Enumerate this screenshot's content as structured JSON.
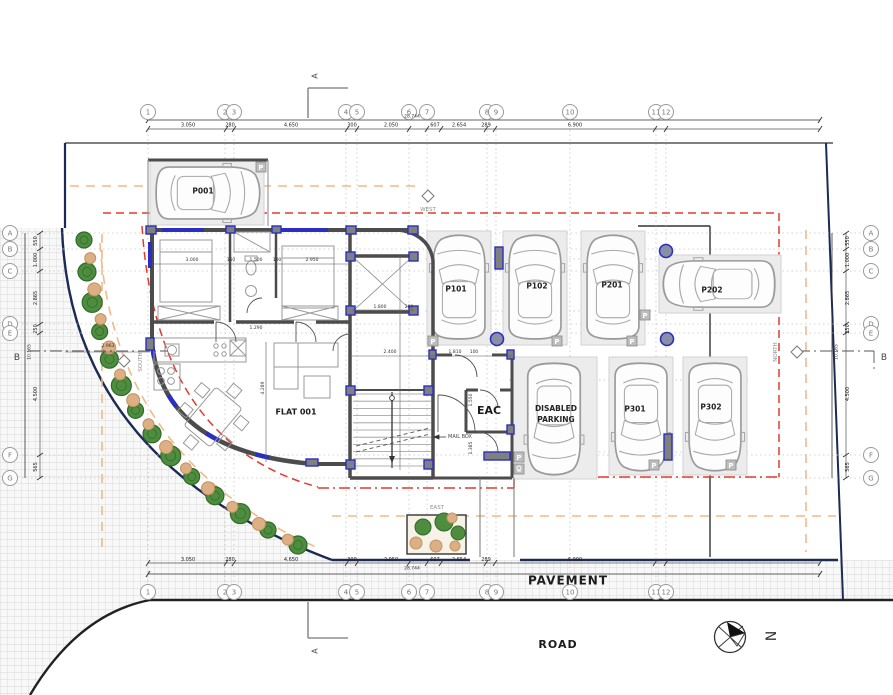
{
  "labels": {
    "pavement": "PAVEMENT",
    "road": "ROAD",
    "flat": "FLAT 001",
    "eac": "EAC",
    "mailbox": "MAIL BOX",
    "west": "WEST",
    "east": "EAST",
    "south": "SOUTH",
    "north": "NORTH",
    "section_a": "A",
    "section_b": "B",
    "north_arrow_letter": "N"
  },
  "grid_cols": [
    {
      "label": "1",
      "x": 148
    },
    {
      "label": "2",
      "x": 225
    },
    {
      "label": "3",
      "x": 234
    },
    {
      "label": "4",
      "x": 346
    },
    {
      "label": "5",
      "x": 357
    },
    {
      "label": "6",
      "x": 409
    },
    {
      "label": "7",
      "x": 427
    },
    {
      "label": "8",
      "x": 487
    },
    {
      "label": "9",
      "x": 496
    },
    {
      "label": "10",
      "x": 570
    },
    {
      "label": "11",
      "x": 656
    },
    {
      "label": "12",
      "x": 666
    }
  ],
  "grid_rows": [
    {
      "label": "A",
      "y": 233
    },
    {
      "label": "B",
      "y": 249
    },
    {
      "label": "C",
      "y": 271
    },
    {
      "label": "D",
      "y": 324
    },
    {
      "label": "E",
      "y": 333
    },
    {
      "label": "F",
      "y": 455
    },
    {
      "label": "G",
      "y": 478
    }
  ],
  "dims": {
    "top": [
      {
        "t": "3.050",
        "x": 188
      },
      {
        "t": "280",
        "x": 230
      },
      {
        "t": "4.650",
        "x": 291
      },
      {
        "t": "300",
        "x": 352
      },
      {
        "t": "2.050",
        "x": 391
      },
      {
        "t": "607",
        "x": 435
      },
      {
        "t": "2.654",
        "x": 459
      },
      {
        "t": "289",
        "x": 486
      },
      {
        "t": "6.900",
        "x": 575
      }
    ],
    "bottom": [
      {
        "t": "3.050",
        "x": 188
      },
      {
        "t": "280",
        "x": 230
      },
      {
        "t": "4.650",
        "x": 291
      },
      {
        "t": "300",
        "x": 352
      },
      {
        "t": "2.050",
        "x": 391
      },
      {
        "t": "607",
        "x": 435
      },
      {
        "t": "2.654",
        "x": 459
      },
      {
        "t": "289",
        "x": 486
      },
      {
        "t": "6.900",
        "x": 575
      }
    ],
    "left": [
      {
        "t": "550",
        "y": 241
      },
      {
        "t": "1.000",
        "y": 260
      },
      {
        "t": "2.865",
        "y": 298
      },
      {
        "t": "250",
        "y": 329
      },
      {
        "t": "4.500",
        "y": 394
      },
      {
        "t": "565",
        "y": 467
      }
    ],
    "right": [
      {
        "t": "550",
        "y": 241
      },
      {
        "t": "1.000",
        "y": 260
      },
      {
        "t": "2.865",
        "y": 298
      },
      {
        "t": "250",
        "y": 329
      },
      {
        "t": "4.500",
        "y": 394
      },
      {
        "t": "565",
        "y": 467
      }
    ],
    "top_total": "28.744",
    "bottom_total": "28.744",
    "left_total": "10.165",
    "right_total": "10.165"
  },
  "interior_dims": [
    {
      "t": "3.000",
      "x": 192,
      "y": 261
    },
    {
      "t": "150",
      "x": 231,
      "y": 261
    },
    {
      "t": "1.500",
      "x": 256,
      "y": 261
    },
    {
      "t": "100",
      "x": 277,
      "y": 261
    },
    {
      "t": "2.950",
      "x": 312,
      "y": 261
    },
    {
      "t": "1.800",
      "x": 380,
      "y": 308
    },
    {
      "t": "200",
      "x": 409,
      "y": 308
    },
    {
      "t": "2.400",
      "x": 390,
      "y": 353
    },
    {
      "t": "1.810",
      "x": 455,
      "y": 353
    },
    {
      "t": "100",
      "x": 474,
      "y": 353
    },
    {
      "t": "2.963",
      "x": 108,
      "y": 347
    },
    {
      "t": "1.290",
      "x": 256,
      "y": 329
    },
    {
      "t": "4.289",
      "x": 264,
      "y": 388,
      "rot": 1
    },
    {
      "t": "1.550",
      "x": 472,
      "y": 400,
      "rot": 1
    },
    {
      "t": "1.385",
      "x": 472,
      "y": 448,
      "rot": 1
    }
  ],
  "parking": [
    {
      "label": "P001",
      "x": 150,
      "y": 161,
      "w": 114,
      "h": 64,
      "dir": "h",
      "rot": 90,
      "lox": -4,
      "loy": -2
    },
    {
      "label": "P101",
      "x": 427,
      "y": 231,
      "w": 64,
      "h": 114,
      "dir": "v",
      "rot": 0,
      "lox": -3,
      "loy": 1
    },
    {
      "label": "P102",
      "x": 503,
      "y": 231,
      "w": 64,
      "h": 114,
      "dir": "v",
      "rot": 0,
      "lox": 2,
      "loy": -2
    },
    {
      "label": "P201",
      "x": 581,
      "y": 231,
      "w": 64,
      "h": 114,
      "dir": "v",
      "rot": 0,
      "lox": -1,
      "loy": -3
    },
    {
      "label": "P202",
      "x": 659,
      "y": 255,
      "w": 122,
      "h": 58,
      "dir": "h",
      "rot": -90,
      "lox": -8,
      "loy": 6
    },
    {
      "label": "DISABLED PARKING",
      "x": 511,
      "y": 357,
      "w": 86,
      "h": 122,
      "dir": "v",
      "rot": 180,
      "lox": 2,
      "loy": -7,
      "twoline": true
    },
    {
      "label": "P301",
      "x": 609,
      "y": 357,
      "w": 64,
      "h": 118,
      "dir": "v",
      "rot": 180,
      "lox": -6,
      "loy": -7
    },
    {
      "label": "P302",
      "x": 683,
      "y": 357,
      "w": 64,
      "h": 118,
      "dir": "v",
      "rot": 180,
      "lox": -4,
      "loy": -9
    }
  ],
  "parking_sign_letter": "P",
  "colors": {
    "wall": "#4c4c4c",
    "column_blue": "#2b2fc0",
    "column_fill": "#7e84cf",
    "boundary_navy": "#1c2a56",
    "red_dash": "#e23b2e",
    "orange_dash": "#efba8b",
    "tree_green": "#4e8c3f",
    "tree_green_edge": "#2f6b28",
    "tree_tan": "#dcaf85",
    "tree_tan_edge": "#c4935f",
    "stall_fill": "#ececec",
    "hatch_line": "#cfcfcf",
    "dotted_grid": "#c5c5c5"
  }
}
